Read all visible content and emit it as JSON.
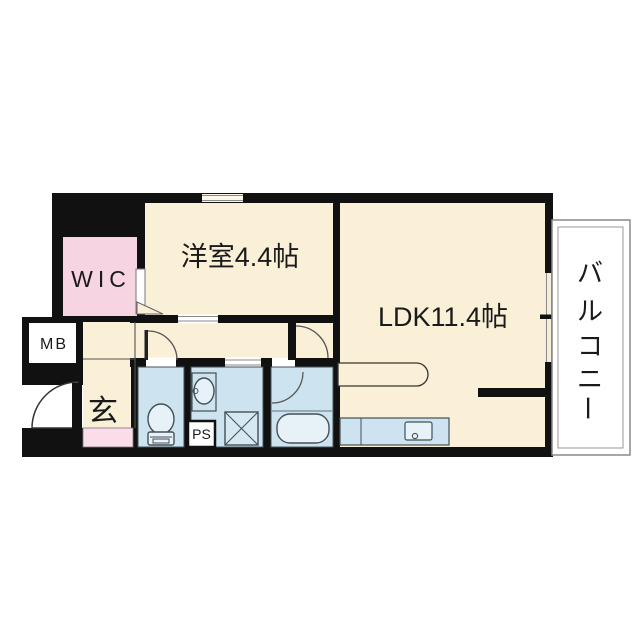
{
  "floorplan": {
    "rooms": {
      "western_room": {
        "label": "洋室4.4帖"
      },
      "ldk": {
        "label": "LDK11.4帖"
      },
      "wic": {
        "label": "WIC"
      },
      "meter_box": {
        "label": "MB"
      },
      "entrance": {
        "label": "玄"
      },
      "pipe_space": {
        "label": "PS"
      },
      "balcony": {
        "label": "バルコニー",
        "label_chars": [
          "バ",
          "ル",
          "コ",
          "ニ",
          "ー"
        ]
      }
    },
    "colors": {
      "wall": "#111111",
      "floor_cream": "#faf0d8",
      "wet_room_blue": "#cde3ef",
      "wic_pink": "#f7d4e2",
      "entrance_step_pink": "#fbdde9",
      "balcony_border_gray": "#8a8a8a"
    }
  }
}
